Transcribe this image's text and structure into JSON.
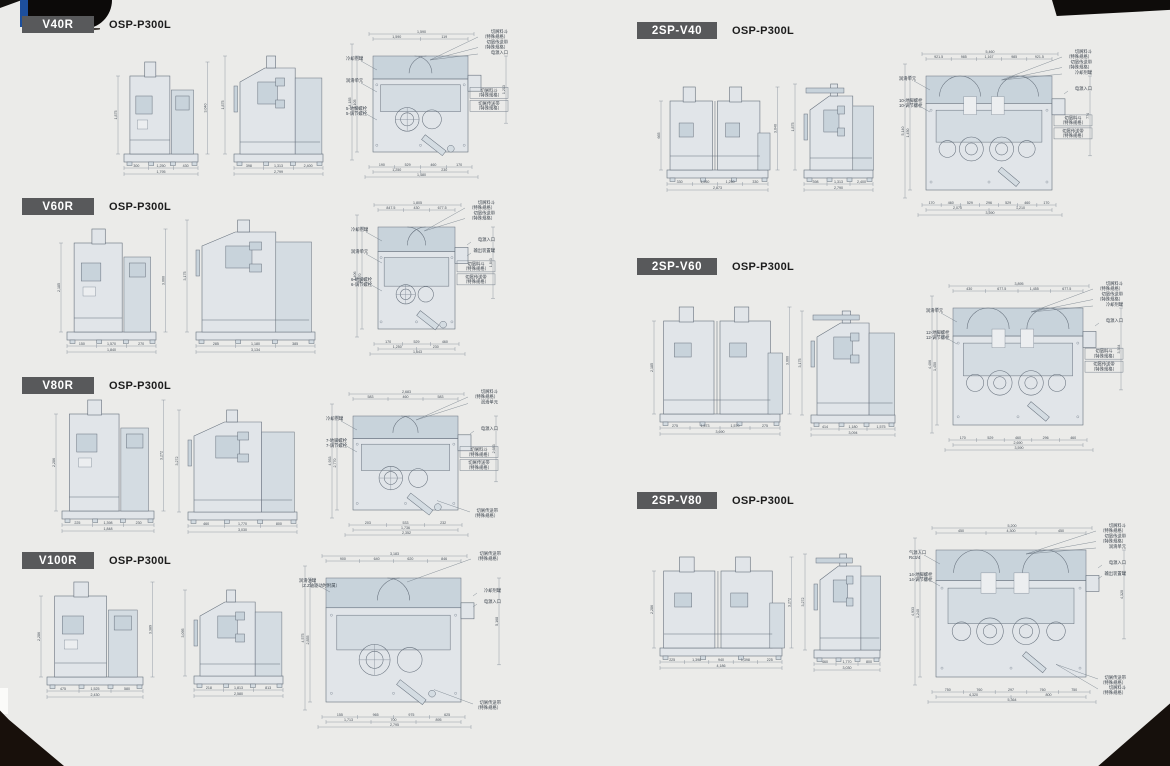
{
  "page": {
    "background": "#ebebe9",
    "accent_blue": "#1d4f9c",
    "badge_bg": "#58595b",
    "drawing_line": "#66707c",
    "machine_fill": "#e1e5e9",
    "panel_fill": "#c8d3db"
  },
  "sections": [
    {
      "id": "v40r",
      "model": "V40R",
      "control": "OSP-P300L",
      "twin": false,
      "views": {
        "front": {
          "b1": [
            "300",
            "1,250",
            "430"
          ],
          "total": "1,795",
          "height": "3,040",
          "h2": "1,875"
        },
        "side": {
          "b1": [
            "398",
            "1,313",
            "2,400"
          ],
          "total": "2,799",
          "height": "1,875"
        },
        "plan": {
          "t1": [
            "1,590",
            "119"
          ],
          "t_total": "1,590",
          "b1": [
            "190",
            "529",
            "460",
            "170"
          ],
          "b2": [
            "1,250",
            "230"
          ],
          "total": "1,480",
          "total2": "1,213",
          "left": "4,185",
          "right": "1,105"
        }
      },
      "plan_labels": {
        "top": [
          [
            "切屑料斗",
            "（特殊规格）"
          ],
          [
            "切屑传送带",
            "（特殊规格）"
          ],
          [
            "电源入口"
          ]
        ],
        "right": [],
        "boxed": [
          [
            "切屑料斗",
            "（特殊规格）"
          ],
          [
            "切屑传送带",
            "（特殊规格）"
          ]
        ],
        "left": [
          [
            "冷却剂罐"
          ],
          [
            "润滑单元"
          ],
          [
            "5-地脚螺栓",
            "5-调节螺栓"
          ]
        ],
        "bottom": []
      }
    },
    {
      "id": "v60r",
      "model": "V60R",
      "control": "OSP-P300L",
      "twin": false,
      "views": {
        "front": {
          "b1": [
            "150",
            "1,570",
            "270"
          ],
          "total": "1,840",
          "height": "3,060",
          "h2": "2,185"
        },
        "side": {
          "b1": [
            "285",
            "1,180",
            "385"
          ],
          "total": "3,134",
          "height": "3,175"
        },
        "plan": {
          "t1": [
            "847.5",
            "430",
            "677.5"
          ],
          "t_total": "1,805",
          "b1": [
            "170",
            "529",
            "460"
          ],
          "b2": [
            "1,250",
            "230"
          ],
          "total": "1,643",
          "total2": "1,843",
          "left": "4,406",
          "right": "2,770"
        }
      },
      "plan_labels": {
        "top": [
          [
            "切屑料斗",
            "（特殊规格）"
          ],
          [
            "切屑传送带",
            "（特殊规格）"
          ]
        ],
        "right": [
          [
            "电源入口"
          ],
          [
            "输出装置罐"
          ]
        ],
        "boxed": [
          [
            "切屑料斗",
            "（特殊规格）"
          ],
          [
            "切屑传送带",
            "（特殊规格）"
          ]
        ],
        "left": [
          [
            "冷却剂罐"
          ],
          [
            "润滑单元"
          ],
          [
            "6-地脚螺栓",
            "6-调节螺栓"
          ]
        ],
        "bottom": []
      }
    },
    {
      "id": "v80r",
      "model": "V80R",
      "control": "OSP-P300L",
      "twin": false,
      "views": {
        "front": {
          "b1": [
            "225",
            "1,398",
            "230"
          ],
          "total": "1,848",
          "height": "3,272",
          "h2": "2,286"
        },
        "side": {
          "b1": [
            "460",
            "1,770",
            "800"
          ],
          "total": "3,030",
          "height": "3,272"
        },
        "plan": {
          "t1": [
            "583",
            "460",
            "583"
          ],
          "t_total": "2,683",
          "b1": [
            "203",
            "533",
            "232"
          ],
          "b2": [
            "1,736"
          ],
          "total": "2,352",
          "total2": "2,683",
          "left": "4,933",
          "right": "2,770"
        }
      },
      "plan_labels": {
        "top": [
          [
            "切屑料斗",
            "（特殊规格）"
          ],
          [
            "润滑单元"
          ]
        ],
        "right": [
          [
            "电源入口"
          ]
        ],
        "boxed": [
          [
            "切屑料斗",
            "（特殊规格）"
          ],
          [
            "切屑传送带",
            "（特殊规格）"
          ]
        ],
        "left": [
          [
            "冷却剂罐"
          ],
          [
            "7-地脚螺栓",
            "7-调节螺栓"
          ]
        ],
        "bottom": [
          [
            "切屑传送带",
            "（特殊规格）"
          ]
        ]
      }
    },
    {
      "id": "v100r",
      "model": "V100R",
      "control": "OSP-P300L",
      "twin": false,
      "views": {
        "front": {
          "b1": [
            "475",
            "1,525",
            "580"
          ],
          "total": "2,430",
          "height": "3,389",
          "h2": "2,286"
        },
        "side": {
          "b1": [
            "218",
            "1,813",
            "813"
          ],
          "total": "2,580",
          "height": "3,095"
        },
        "plan": {
          "t1": [
            "900",
            "640",
            "620",
            "846"
          ],
          "t_total": "3,183",
          "b1": [
            "155",
            "965",
            "975",
            "625"
          ],
          "b2": [
            "1,713",
            "700",
            "895"
          ],
          "total": "2,795",
          "total2": "5,168",
          "left": "4,575",
          "right": "2,855"
        }
      },
      "plan_labels": {
        "top": [
          [
            "切屑传送带",
            "（特殊规格）"
          ]
        ],
        "right": [
          [
            "冷却剂罐"
          ],
          [
            "电源入口"
          ]
        ],
        "boxed": [],
        "left": [
          [
            "润滑油罐",
            "（Z.Z轴驱动时附属）"
          ]
        ],
        "bottom": [
          [
            "切屑传送带",
            "（特殊规格）"
          ]
        ]
      }
    },
    {
      "id": "2sp-v40",
      "model": "2SP-V40",
      "control": "OSP-P300L",
      "twin": true,
      "views": {
        "front": {
          "b1": [
            "330",
            "1,250",
            "1,250",
            "330"
          ],
          "total": "2,873",
          "height": "3,040",
          "h2": "665"
        },
        "side": {
          "b1": [
            "398",
            "1,313",
            "2,400"
          ],
          "total": "2,790",
          "height": "1,875"
        },
        "plan": {
          "t1": [
            "921.5",
            "985",
            "1,167",
            "985",
            "921.5"
          ],
          "t_total": "5,460",
          "b1": [
            "170",
            "460",
            "529",
            "296",
            "529",
            "460",
            "170"
          ],
          "b2": [
            "2,070",
            "1,210"
          ],
          "total": "3,590",
          "total2": "774",
          "left": "5,140",
          "right": "1,450"
        }
      },
      "plan_labels": {
        "top": [
          [
            "切屑料斗",
            "（特殊规格）"
          ],
          [
            "切屑传送带",
            "（特殊规格）"
          ],
          [
            "冷却剂罐"
          ]
        ],
        "right": [
          [
            "电源入口"
          ]
        ],
        "boxed": [
          [
            "切屑料斗",
            "（特殊规格）"
          ],
          [
            "切屑传送带",
            "（特殊规格）"
          ]
        ],
        "left": [
          [
            "润滑单元"
          ],
          [
            "10-地脚螺栓",
            "10-调节螺栓"
          ]
        ],
        "bottom": []
      }
    },
    {
      "id": "2sp-v60",
      "model": "2SP-V60",
      "control": "OSP-P300L",
      "twin": true,
      "views": {
        "front": {
          "b1": [
            "275",
            "1,573",
            "1,570",
            "275"
          ],
          "total": "3,690",
          "height": "3,060",
          "h2": "2,185"
        },
        "side": {
          "b1": [
            "414",
            "1,180",
            "1,575"
          ],
          "total": "3,094",
          "height": "3,175"
        },
        "plan": {
          "t1": [
            "430",
            "677.5",
            "1,455",
            "677.5"
          ],
          "t_total": "3,895",
          "b1": [
            "170",
            "529",
            "460",
            "296",
            "460"
          ],
          "b2": [
            "2,690"
          ],
          "total": "3,590",
          "total2": "3,364",
          "left": "4,406",
          "right": "1,450"
        }
      },
      "plan_labels": {
        "top": [
          [
            "切屑料斗",
            "（特殊规格）"
          ],
          [
            "切屑传送带",
            "（特殊规格）"
          ],
          [
            "冷却剂罐"
          ]
        ],
        "right": [
          [
            "电源入口"
          ]
        ],
        "boxed": [
          [
            "切屑料斗",
            "（特殊规格）"
          ],
          [
            "切屑传送带",
            "（特殊规格）"
          ]
        ],
        "left": [
          [
            "润滑单元"
          ],
          [
            "12-地脚螺栓",
            "12-调节螺栓"
          ]
        ],
        "bottom": []
      }
    },
    {
      "id": "2sp-v80",
      "model": "2SP-V80",
      "control": "OSP-P300L",
      "twin": true,
      "views": {
        "front": {
          "b1": [
            "225",
            "1,398",
            "940",
            "1,398",
            "225"
          ],
          "total": "4,186",
          "height": "3,272",
          "h2": "2,286"
        },
        "side": {
          "b1": [
            "460",
            "1,770",
            "800"
          ],
          "total": "3,030",
          "height": "3,272"
        },
        "plan": {
          "t1": [
            "450",
            "4,300",
            "450"
          ],
          "t_total": "5,200",
          "b1": [
            "750",
            "760",
            "297",
            "760",
            "750"
          ],
          "b2": [
            "4,320",
            "800"
          ],
          "total": "5,364",
          "total2": "4,320",
          "left": "4,933",
          "right": "1,240"
        }
      },
      "plan_labels": {
        "top": [
          [
            "切屑料斗",
            "（特殊规格）"
          ],
          [
            "切屑传送带",
            "（特殊规格）"
          ],
          [
            "润滑单元"
          ]
        ],
        "right": [
          [
            "电源入口"
          ],
          [
            "输出装置罐"
          ]
        ],
        "boxed": [],
        "left": [
          [
            "气源入口",
            "Rc3/4"
          ],
          [
            "14-地脚螺栓",
            "14-调节螺栓"
          ]
        ],
        "bottom": [
          [
            "切屑传送带",
            "（特殊规格）"
          ],
          [
            "切屑料斗",
            "（特殊规格）"
          ]
        ]
      }
    }
  ]
}
